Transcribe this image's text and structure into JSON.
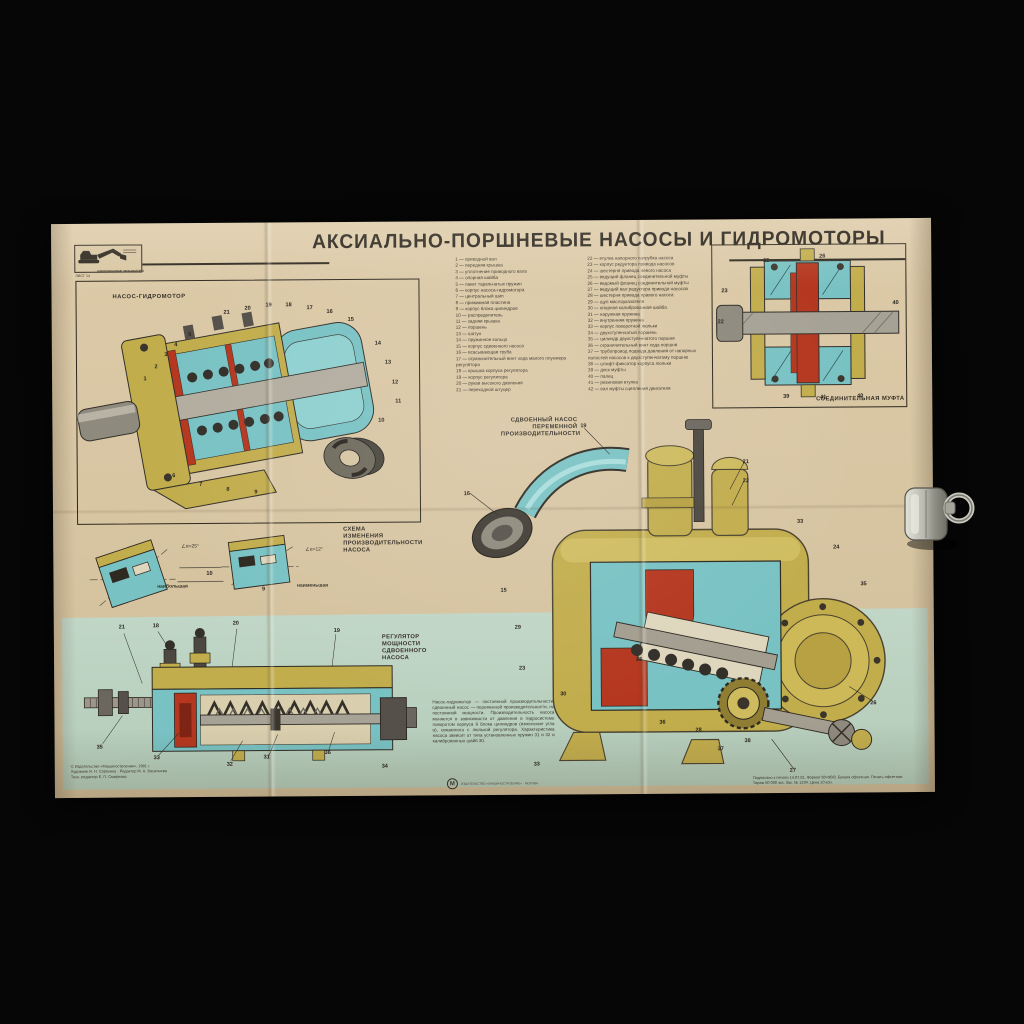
{
  "poster": {
    "title": "АКСИАЛЬНО-ПОРШНЕВЫЕ НАСОСЫ И ГИДРОМОТОРЫ",
    "series_label": "ОДНОКОВШОВЫЕ ЭКСКАВАТОРЫ",
    "sheet_label": "ЛИСТ 14",
    "colors": {
      "paper": "#d7c5a2",
      "green_band": "#bcd2c1",
      "teal": "#79c2c4",
      "khaki": "#c2ad4d",
      "red": "#b5371f",
      "metal_gray": "#a19c8e",
      "ink": "#2d281f"
    }
  },
  "panels": {
    "pump_motor": {
      "title": "НАСОС-ГИДРОМОТОР",
      "callouts": [
        {
          "t": "1",
          "x": 20,
          "y": 40
        },
        {
          "t": "2",
          "x": 23,
          "y": 35
        },
        {
          "t": "3",
          "x": 26,
          "y": 30
        },
        {
          "t": "4",
          "x": 29,
          "y": 26
        },
        {
          "t": "5",
          "x": 33,
          "y": 22
        },
        {
          "t": "21",
          "x": 44,
          "y": 13
        },
        {
          "t": "20",
          "x": 50,
          "y": 11
        },
        {
          "t": "19",
          "x": 56,
          "y": 10
        },
        {
          "t": "18",
          "x": 62,
          "y": 10
        },
        {
          "t": "17",
          "x": 68,
          "y": 11
        },
        {
          "t": "16",
          "x": 74,
          "y": 13
        },
        {
          "t": "15",
          "x": 80,
          "y": 16
        },
        {
          "t": "6",
          "x": 28,
          "y": 80
        },
        {
          "t": "7",
          "x": 36,
          "y": 84
        },
        {
          "t": "8",
          "x": 44,
          "y": 86
        },
        {
          "t": "9",
          "x": 52,
          "y": 87
        },
        {
          "t": "14",
          "x": 88,
          "y": 26
        },
        {
          "t": "13",
          "x": 91,
          "y": 34
        },
        {
          "t": "12",
          "x": 93,
          "y": 42
        },
        {
          "t": "11",
          "x": 94,
          "y": 50
        },
        {
          "t": "10",
          "x": 89,
          "y": 58
        }
      ]
    },
    "coupling": {
      "title": "СОЕДИНИТЕЛЬНАЯ МУФТА",
      "callouts": [
        {
          "t": "23",
          "x": 6,
          "y": 28
        },
        {
          "t": "22",
          "x": 4,
          "y": 47
        },
        {
          "t": "25",
          "x": 28,
          "y": 9
        },
        {
          "t": "26",
          "x": 57,
          "y": 7
        },
        {
          "t": "40",
          "x": 95,
          "y": 36
        },
        {
          "t": "39",
          "x": 38,
          "y": 93
        },
        {
          "t": "41",
          "x": 57,
          "y": 94
        },
        {
          "t": "40",
          "x": 76,
          "y": 93
        }
      ]
    },
    "double_pump": {
      "title_lines": [
        "СДВОЕННЫЙ НАСОС",
        "ПЕРЕМЕННОЙ",
        "ПРОИЗВОДИТЕЛЬНОСТИ"
      ],
      "callouts": [
        {
          "t": "19",
          "x": 32,
          "y": 4
        },
        {
          "t": "21",
          "x": 68,
          "y": 14
        },
        {
          "t": "22",
          "x": 68,
          "y": 19
        },
        {
          "t": "16",
          "x": 6,
          "y": 22
        },
        {
          "t": "33",
          "x": 80,
          "y": 30
        },
        {
          "t": "24",
          "x": 88,
          "y": 37
        },
        {
          "t": "35",
          "x": 94,
          "y": 47
        },
        {
          "t": "15",
          "x": 14,
          "y": 48
        },
        {
          "t": "29",
          "x": 17,
          "y": 58
        },
        {
          "t": "23",
          "x": 18,
          "y": 69
        },
        {
          "t": "30",
          "x": 27,
          "y": 76
        },
        {
          "t": "25",
          "x": 44,
          "y": 67
        },
        {
          "t": "36",
          "x": 49,
          "y": 84
        },
        {
          "t": "28",
          "x": 57,
          "y": 86
        },
        {
          "t": "37",
          "x": 62,
          "y": 91
        },
        {
          "t": "38",
          "x": 68,
          "y": 89
        },
        {
          "t": "26",
          "x": 96,
          "y": 79
        },
        {
          "t": "27",
          "x": 78,
          "y": 97
        },
        {
          "t": "33",
          "x": 21,
          "y": 95
        }
      ]
    },
    "scheme": {
      "title_lines": [
        "СХЕМА ИЗМЕНЕНИЯ",
        "ПРОИЗВОДИТЕЛЬНОСТИ",
        "НАСОСА"
      ],
      "left_caption": "наибольшая",
      "right_caption": "наименьшая",
      "left_angle": "∠α=25°",
      "right_angle": "∠α=12°",
      "callouts": [
        {
          "t": "10",
          "x": 42,
          "y": 54
        },
        {
          "t": "9",
          "x": 60,
          "y": 72
        }
      ]
    },
    "regulator": {
      "title_lines": [
        "РЕГУЛЯТОР",
        "МОЩНОСТИ",
        "СДВОЕННОГО",
        "НАСОСА"
      ],
      "callouts": [
        {
          "t": "21",
          "x": 12,
          "y": 2
        },
        {
          "t": "18",
          "x": 22,
          "y": 1
        },
        {
          "t": "20",
          "x": 46,
          "y": 0
        },
        {
          "t": "19",
          "x": 76,
          "y": 5
        },
        {
          "t": "35",
          "x": 5,
          "y": 78
        },
        {
          "t": "33",
          "x": 22,
          "y": 85
        },
        {
          "t": "32",
          "x": 44,
          "y": 89
        },
        {
          "t": "31",
          "x": 55,
          "y": 85
        },
        {
          "t": "36",
          "x": 73,
          "y": 82
        },
        {
          "t": "34",
          "x": 90,
          "y": 91
        }
      ]
    }
  },
  "parts_list": {
    "left": [
      "1 — приводной вал",
      "2 — передняя крышка",
      "3 — уплотнение приводного вала",
      "4 — опорная шайба",
      "5 — пакет тарельчатых пружин",
      "6 — корпус насоса-гидромотора",
      "7 — центральный шип",
      "8 — прижимная пластина",
      "9 — корпус блока цилиндров",
      "10 — распределитель",
      "11 — задняя крышка",
      "12 — поршень",
      "13 — шатун",
      "14 — пружинное кольцо",
      "15 — корпус сдвоенного насоса",
      "16 — всасывающая труба",
      "17 — ограничительный винт хода малого плунжера регулятора",
      "18 — крышка корпуса регулятора",
      "19 — корпус регулятора",
      "20 — рукав высокого давления",
      "21 — переходной штуцер"
    ],
    "right": [
      "22 — втулка напорного патрубка насоса",
      "23 — корпус редуктора привода насосов",
      "24 — шестерня привода левого насоса",
      "25 — ведущий фланец соединительной муфты",
      "26 — ведомый фланец соединительной муфты",
      "27 — ведущий вал редуктора привода насосов",
      "28 — шестерня привода правого насоса",
      "29 — щуп маслоуказателя",
      "30 — опорная калиброванная шайба",
      "31 — наружная пружина",
      "32 — внутренняя пружина",
      "33 — корпус поворотной люльки",
      "34 — двухступенчатый поршень",
      "35 — цилиндр двухступенчатого поршня",
      "36 — ограничительный винт хода поршня",
      "37 — трубопровод подвода давления от напорных полостей насосов к двухступенчатому поршню",
      "38 — штифт-фиксатор корпуса люльки",
      "39 — диск муфты",
      "40 — палец",
      "41 — резиновая втулка",
      "42 — вал муфты сцепления двигателя"
    ]
  },
  "description": "Насос-гидромотор — постоянной производительности, сдвоенный насос — переменной производительности, но постоянной мощности. Производительность насоса меняется в зависимости от давления в гидросистеме поворотом корпуса 9 блока цилиндров (изменение угла α), связанного с люлькой регулятора. Характеристика насоса зависит от типа установленных пружин 31 и 32 и калиброванных шайб 30.",
  "footer": {
    "credits_left": [
      "© Издательство «Машиностроение», 1981 г.",
      "Художник И. Н. Сорокина · Редактор М. А. Васильева",
      "Техн. редактор Е. П. Смирнова"
    ],
    "imprint_right": [
      "Подписано к печати 14.07.81. Формат 60×90/8. Бумага офсетная. Печать офсетная.",
      "Тираж 50 000 экз. Зак. № 1234. Цена 10 коп."
    ],
    "emblem_letter": "М",
    "emblem_text": "ИЗДАТЕЛЬСТВО «МАШИНОСТРОЕНИЕ» · МОСКВА"
  }
}
